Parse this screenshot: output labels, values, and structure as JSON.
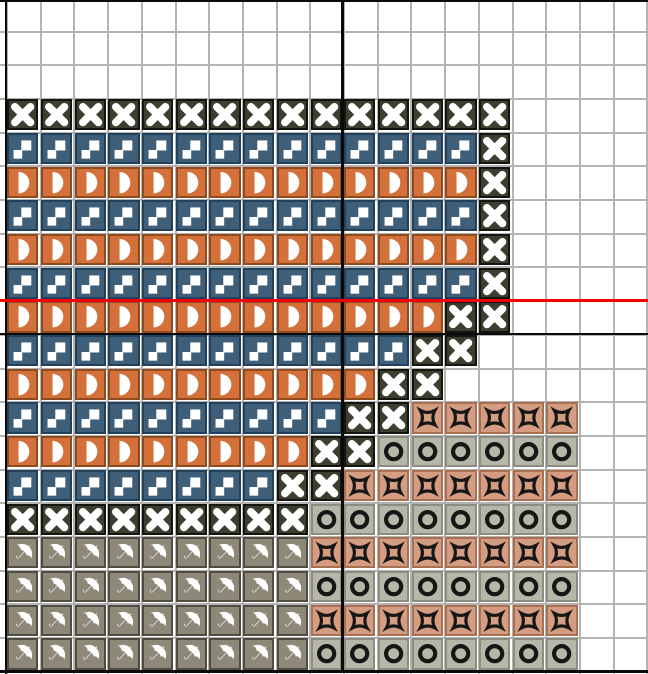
{
  "canvas": {
    "width": 648,
    "height": 674,
    "grid": {
      "origin_x": 6,
      "origin_y": -3.2,
      "cell_w": 33.7,
      "cell_h": 33.7,
      "cols": 19,
      "rows": 20,
      "line_color": "#b3b3b3",
      "background": "#ffffff"
    }
  },
  "legend": {
    "X": {
      "name": "cross-x-stitch",
      "fill": "#3e3e30",
      "border": "#15150f",
      "symbol": "bold-x",
      "symbol_color": "#ffffff"
    },
    "S": {
      "name": "steps-stitch",
      "fill": "#3f5e78",
      "border": "#20405c",
      "symbol": "steps",
      "symbol_color": "#ffffff"
    },
    "D": {
      "name": "half-disc-stitch",
      "fill": "#d4713a",
      "border": "#8f4a1e",
      "symbol": "half-disc",
      "symbol_color": "#ffffff"
    },
    "U": {
      "name": "umbrella-stitch",
      "fill": "#8e8879",
      "border": "#4f4c42",
      "symbol": "umbrella",
      "symbol_color": "#ffffff"
    },
    "O": {
      "name": "ring-stitch",
      "fill": "#b7b7a9",
      "border": "#8c8c80",
      "symbol": "ring",
      "symbol_color": "#161616"
    },
    "B": {
      "name": "concave-box-stitch",
      "fill": "#d49c80",
      "border": "#a96f52",
      "symbol": "concave-box",
      "symbol_color": "#161616"
    }
  },
  "pattern": [
    "...................",
    "...................",
    "...................",
    "XXXXXXXXXXXXXXX....",
    "SSSSSSSSSSSSSSX....",
    "DDDDDDDDDDDDDDX....",
    "SSSSSSSSSSSSSSX....",
    "DDDDDDDDDDDDDDX....",
    "SSSSSSSSSSSSSSX....",
    "DDDDDDDDDDDDDXX....",
    "SSSSSSSSSSSSXX.....",
    "DDDDDDDDDDDXX......",
    "SSSSSSSSSSXXBBBBB..",
    "DDDDDDDDDXXOOOOOO..",
    "SSSSSSSSXXBBBBBBB..",
    "XXXXXXXXXOOOOOOOO..",
    "UUUUUUUUUBBBBBBBB..",
    "UUUUUUUUUOOOOOOOO..",
    "UUUUUUUUUBBBBBBBB..",
    "UUUUUUUUUOOOOOOOO.."
  ],
  "lines": {
    "black_vertical": [
      {
        "x": 4.5,
        "y": 0,
        "w": 2.5,
        "h": 674
      },
      {
        "x": 341.3,
        "y": 0,
        "w": 2.5,
        "h": 671
      }
    ],
    "black_horizontal_over": [
      {
        "x": 0,
        "y": 0,
        "w": 648,
        "h": 2.2
      },
      {
        "x": 0,
        "y": 670.3,
        "w": 648,
        "h": 2.5
      }
    ],
    "black_horizontal_under": [
      {
        "x": 0,
        "y": 332.6,
        "w": 648,
        "h": 2.5
      }
    ],
    "red_marker": {
      "x": 0,
      "y": 298.7,
      "w": 648,
      "h": 3.0,
      "color": "#f40000"
    }
  }
}
